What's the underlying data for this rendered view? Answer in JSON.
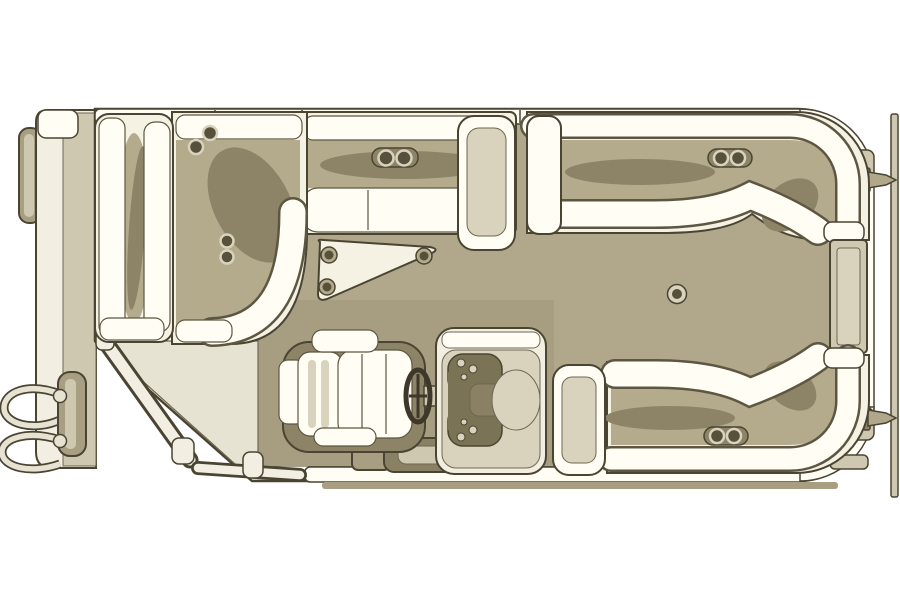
{
  "diagram": {
    "type": "floor-plan",
    "subject": "pontoon-boat-top-view",
    "orientation": "bow-left-stern-right",
    "visible_text": [],
    "palette": {
      "background": "#ffffff",
      "outline": "#4a4433",
      "outline_soft": "#6e6752",
      "line_mid": "#5d5642",
      "white": "#fffdf4",
      "cream": "#f2efe2",
      "base_cream": "#f5f2e4",
      "floor_bow": "#e7e3d2",
      "deck": "#b1a88b",
      "helm_floor": "#a79e81",
      "shade": "#8d8468",
      "khaki_mid": "#b4ab8d",
      "trim": "#cfc8b1",
      "trim_deep": "#a89f82",
      "dark": "#57503a",
      "dash_dark": "#7b7355",
      "panel": "#d9d3bd",
      "box": "#8a8164"
    },
    "components": [
      {
        "id": "bow-pontoon-nose",
        "kind": "hull"
      },
      {
        "id": "port-hull-side",
        "kind": "hull"
      },
      {
        "id": "boarding-ladder",
        "kind": "hardware"
      },
      {
        "id": "bow-gate-fence",
        "kind": "rail"
      },
      {
        "id": "bow-deck",
        "kind": "floor"
      },
      {
        "id": "main-deck",
        "kind": "floor"
      },
      {
        "id": "helm-deck-pad",
        "kind": "floor"
      },
      {
        "id": "bow-lounge",
        "kind": "seating"
      },
      {
        "id": "bow-corner-lounge",
        "kind": "seating"
      },
      {
        "id": "port-bench",
        "kind": "seating"
      },
      {
        "id": "port-bench-armrest",
        "kind": "seating"
      },
      {
        "id": "mount-plate",
        "kind": "fitting",
        "bolts": 3
      },
      {
        "id": "helm-console",
        "kind": "helm"
      },
      {
        "id": "steering-wheel",
        "kind": "helm"
      },
      {
        "id": "captains-chair",
        "kind": "seating"
      },
      {
        "id": "helm-step-storage",
        "kind": "storage"
      },
      {
        "id": "stern-lounge-armrest",
        "kind": "seating"
      },
      {
        "id": "stern-port-lounge",
        "kind": "seating",
        "cup_holders": 2
      },
      {
        "id": "stern-starboard-lounge",
        "kind": "seating",
        "cup_holders": 2
      },
      {
        "id": "stern-gate-panel",
        "kind": "rail"
      },
      {
        "id": "table-mount-base",
        "kind": "fitting"
      },
      {
        "id": "stern-cleat-top",
        "kind": "hardware"
      },
      {
        "id": "stern-cleat-bottom",
        "kind": "hardware"
      },
      {
        "id": "stern-trim-strip",
        "kind": "hull"
      },
      {
        "id": "cup-holders-bow-corner",
        "kind": "fitting",
        "count": 4
      },
      {
        "id": "cup-holders-port-bench",
        "kind": "fitting",
        "count": 2
      }
    ]
  }
}
